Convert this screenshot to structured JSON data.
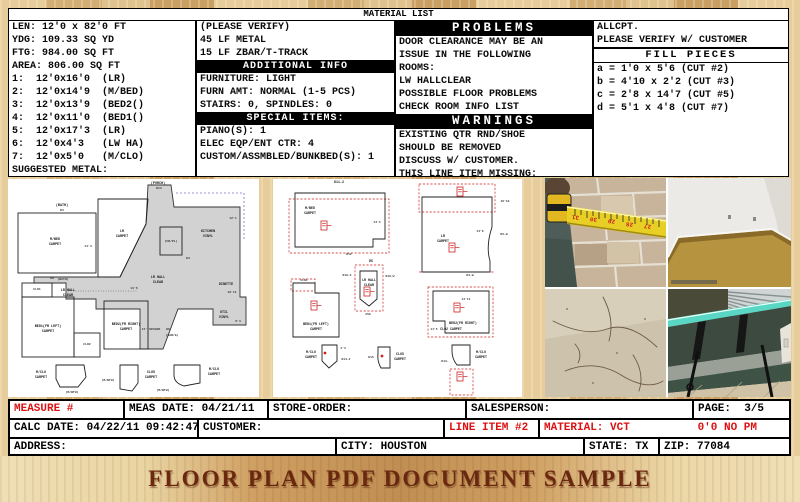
{
  "header": {
    "title": "MATERIAL LIST"
  },
  "columns": {
    "dimensions": {
      "lines": [
        "LEN: 12'0 x 82'0 FT",
        "YDG: 109.33 SQ YD",
        "FTG: 984.00 SQ FT",
        "AREA: 806.00 SQ FT",
        "1:  12'0x16'0  (LR)",
        "2:  12'0x14'9  (M/BED)",
        "3:  12'0x13'9  (BED2()",
        "4:  12'0x11'0  (BED1()",
        "5:  12'0x17'3  (LR)",
        "6:  12'0x4'3   (LW HA)",
        "7:  12'0x5'0   (M/CLO)",
        "SUGGESTED METAL:"
      ]
    },
    "materials": {
      "top_lines": [
        "(PLEASE VERIFY)",
        "45 LF METAL",
        "15 LF ZBAR/T-TRACK"
      ],
      "additional_info_header": "ADDITIONAL INFO",
      "additional_info_lines": [
        "FURNITURE: LIGHT",
        "FURN AMT: NORMAL (1-5 PCS)",
        "STAIRS: 0, SPINDLES: 0"
      ],
      "special_items_header": "SPECIAL ITEMS:",
      "special_items_lines": [
        "PIANO(S): 1",
        "ELEC EQP/ENT CTR: 4",
        "CUSTOM/ASSMBLED/BUNKBED(S): 1"
      ]
    },
    "problems": {
      "header": "PROBLEMS",
      "lines": [
        "DOOR CLEARANCE MAY BE AN",
        "ISSUE IN THE FOLLOWING",
        "ROOMS:",
        "LW HALLCLEAR",
        "POSSIBLE FLOOR PROBLEMS",
        "CHECK ROOM INFO LIST"
      ],
      "warnings_header": "WARNINGS",
      "warnings_lines": [
        "EXISTING QTR RND/SHOE",
        "SHOULD BE REMOVED",
        "DISCUSS W/ CUSTOMER.",
        "THIS LINE ITEM MISSING:"
      ]
    },
    "fill_pieces": {
      "top_lines": [
        "ALLCPT.",
        "PLEASE VERIFY W/ CUSTOMER"
      ],
      "header": "FILL PIECES",
      "lines": [
        "a = 1'0 x 5'6 (CUT #2)",
        "b = 4'10 x 2'2 (CUT #3)",
        "c = 2'8 x 14'7 (CUT #5)",
        "d = 5'1 x 4'8 (CUT #7)"
      ]
    }
  },
  "floor_plan": {
    "labels": {
      "porch": "(PORCH)",
      "d13": "D13",
      "bath_top": "(BATH)",
      "d3": "D3",
      "mbed_1": "M/BED",
      "mbed_2": "CARPET",
      "lr_1": "LR",
      "lr_2": "CARPET",
      "kitchen_1": "KITCHEN",
      "kitchen_2": "VINYL",
      "frpl": "(FR/PL)",
      "d4": "D4",
      "hall_l1": "LR HALL",
      "hall_l2": "CLEAR",
      "hall_c1": "LR HALL",
      "hall_c2": "CLEAR",
      "dinette": "DINETTE",
      "util_1": "UTIL",
      "util_2": "VINYL",
      "bath_l": "(BATH)",
      "d9": "D9",
      "clo1": "CLO1",
      "clo2": "CLO2",
      "bed1_1": "BED1(FR LEFT)",
      "bed1_2": "CARPET",
      "bed2_1": "BED2(FR RIGHT)",
      "bed2_2": "CARPET",
      "spacer": "12' SPACER",
      "gar": "(GAR/G)",
      "d6": "D6",
      "mclo_a1": "M/CLO",
      "mclo_a2": "CARPET",
      "mbth_a": "(M/BTH)",
      "clos_1": "CLOS",
      "clos_2": "CARPET",
      "mbth_b": "(M/BTH)",
      "mclo_b1": "M/CLO",
      "mclo_b2": "CARPET",
      "mbth_c": "(M/BTH)",
      "dim_144": "14'4",
      "dim_135": "13'5",
      "dim_1011": "10'11",
      "dim_121": "12'1",
      "dim_54": "5'4"
    }
  },
  "cut_diagrams": {
    "labels": {
      "d11_2": "D11-2",
      "mbed_1": "M/BED",
      "mbed_2": "CARPET",
      "d12": "D12",
      "dim_144": "14'4",
      "lr_1": "LR",
      "lr_2": "CARPET",
      "dim_1610": "16'10",
      "dim_146": "14'6",
      "d5w": "D5-W",
      "d4w": "D4-W",
      "d5": "D5",
      "d10_2": "D10-2",
      "hall_1": "LR HALL",
      "hall_2": "CLEAR",
      "d16w": "D16-W",
      "n250": "250",
      "clo1": "CLO1",
      "bed1_1": "BED1(FR LEFT)",
      "bed1_2": "CARPET",
      "dim_1411": "14'11",
      "bed2_1": "BED2(FR RIGHT)",
      "clo2": "CLO2 CARPET",
      "dim_115": "11'5",
      "mclo_a1": "M/CLO",
      "mclo_a2": "CARPET",
      "dim_44": "4'4",
      "d14_2": "D14-2",
      "d15": "D15",
      "clos_1": "CLOS",
      "clos_2": "CARPET",
      "d13": "D13-",
      "mclo_b1": "M/CLO",
      "mclo_b2": "CARPET"
    }
  },
  "photos": {
    "items": [
      "tape measure on brick wall",
      "empty room with tan carpet",
      "cracked vinyl floor",
      "glass table by window"
    ]
  },
  "form": {
    "measure_label": "MEASURE #",
    "meas_date": "MEAS DATE: 04/21/11",
    "store_order": "STORE-ORDER:",
    "salesperson": "SALESPERSON:",
    "page": "PAGE:  3/5",
    "calc_date": "CALC DATE: 04/22/11 09:42:47",
    "customer": "CUSTOMER:",
    "line_item": "LINE ITEM #2",
    "material": "MATERIAL: VCT",
    "material_extra": "0'0 NO PM",
    "address": "ADDRESS:",
    "city": "CITY: HOUSTON",
    "state": "STATE: TX",
    "zip": "ZIP: 77084"
  },
  "banner": {
    "text": "FLOOR PLAN PDF DOCUMENT SAMPLE"
  },
  "colors": {
    "accent_red": "#DD1111",
    "header_bar": "#000000",
    "plan_gray": "#D2D2D2",
    "banner_text": "#6B2810",
    "wood_light": "#E7CD9B",
    "wood_dark": "#C99F63",
    "tape_yellow": "#E8CF25",
    "carpet_tan": "#B6933F",
    "glass_teal": "#59D6C4"
  }
}
